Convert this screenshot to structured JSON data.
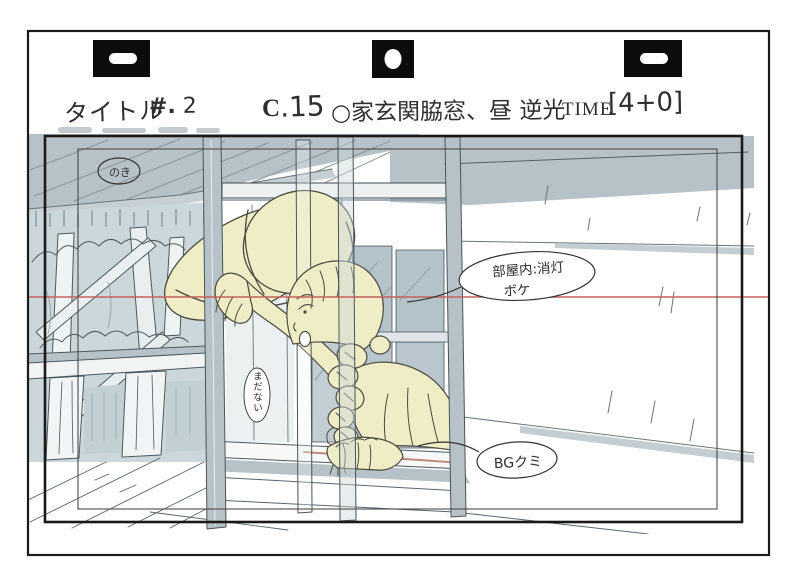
{
  "header": {
    "title_label": "タイトル",
    "episode_label": "#.",
    "episode_number": "2",
    "cut_label": "C",
    "cut_number": ".15",
    "scene_title": "○家玄関脇窓、昼 逆光",
    "time_label": "TIME",
    "time_value": "[4+0]"
  },
  "notes": {
    "eaves": "のき",
    "room_line1": "部屋内:消灯",
    "room_line2": "ボケ",
    "bg": "BGクミ",
    "not_yet": "まだない"
  },
  "colors": {
    "paper": "#ffffff",
    "ink": "#1c1c1c",
    "sketch_line": "#4d585e",
    "blue_gray": "#b7c2c8",
    "tree_wash": "#cbd7da",
    "pane_blue": "#b4c2ca",
    "pale_yellow": "#efedc6",
    "camera_line_red": "#c4625a",
    "sill_pink": "#c08878"
  }
}
